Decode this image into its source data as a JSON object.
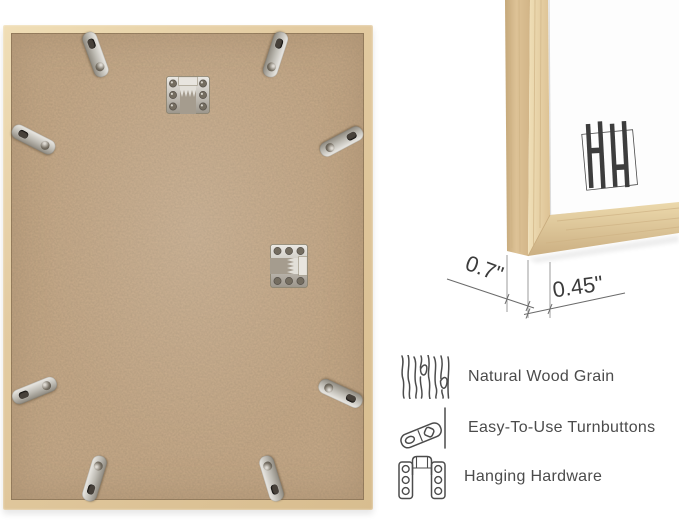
{
  "product_views": {
    "back_view": {
      "turnbutton_count": 8,
      "hanger_count": 2
    },
    "corner_view": {
      "depth_label": "0.7\"",
      "face_width_label": "0.45\""
    }
  },
  "features": [
    {
      "icon": "wood-grain-icon",
      "label": "Natural Wood Grain"
    },
    {
      "icon": "turnbutton-icon",
      "label": "Easy-To-Use Turnbuttons"
    },
    {
      "icon": "hanging-hardware-icon",
      "label": "Hanging Hardware"
    }
  ],
  "colors": {
    "background": "#ffffff",
    "wood_light": "#ecd9b0",
    "wood_mid": "#dcc399",
    "backing": "#c8aa88",
    "metal": "#c9c6bf",
    "label_text": "#4b4b4b",
    "dimension_text": "#3c3c3c",
    "dimension_line": "#6b6b6b",
    "logo_mark": "#3d3d3d"
  }
}
